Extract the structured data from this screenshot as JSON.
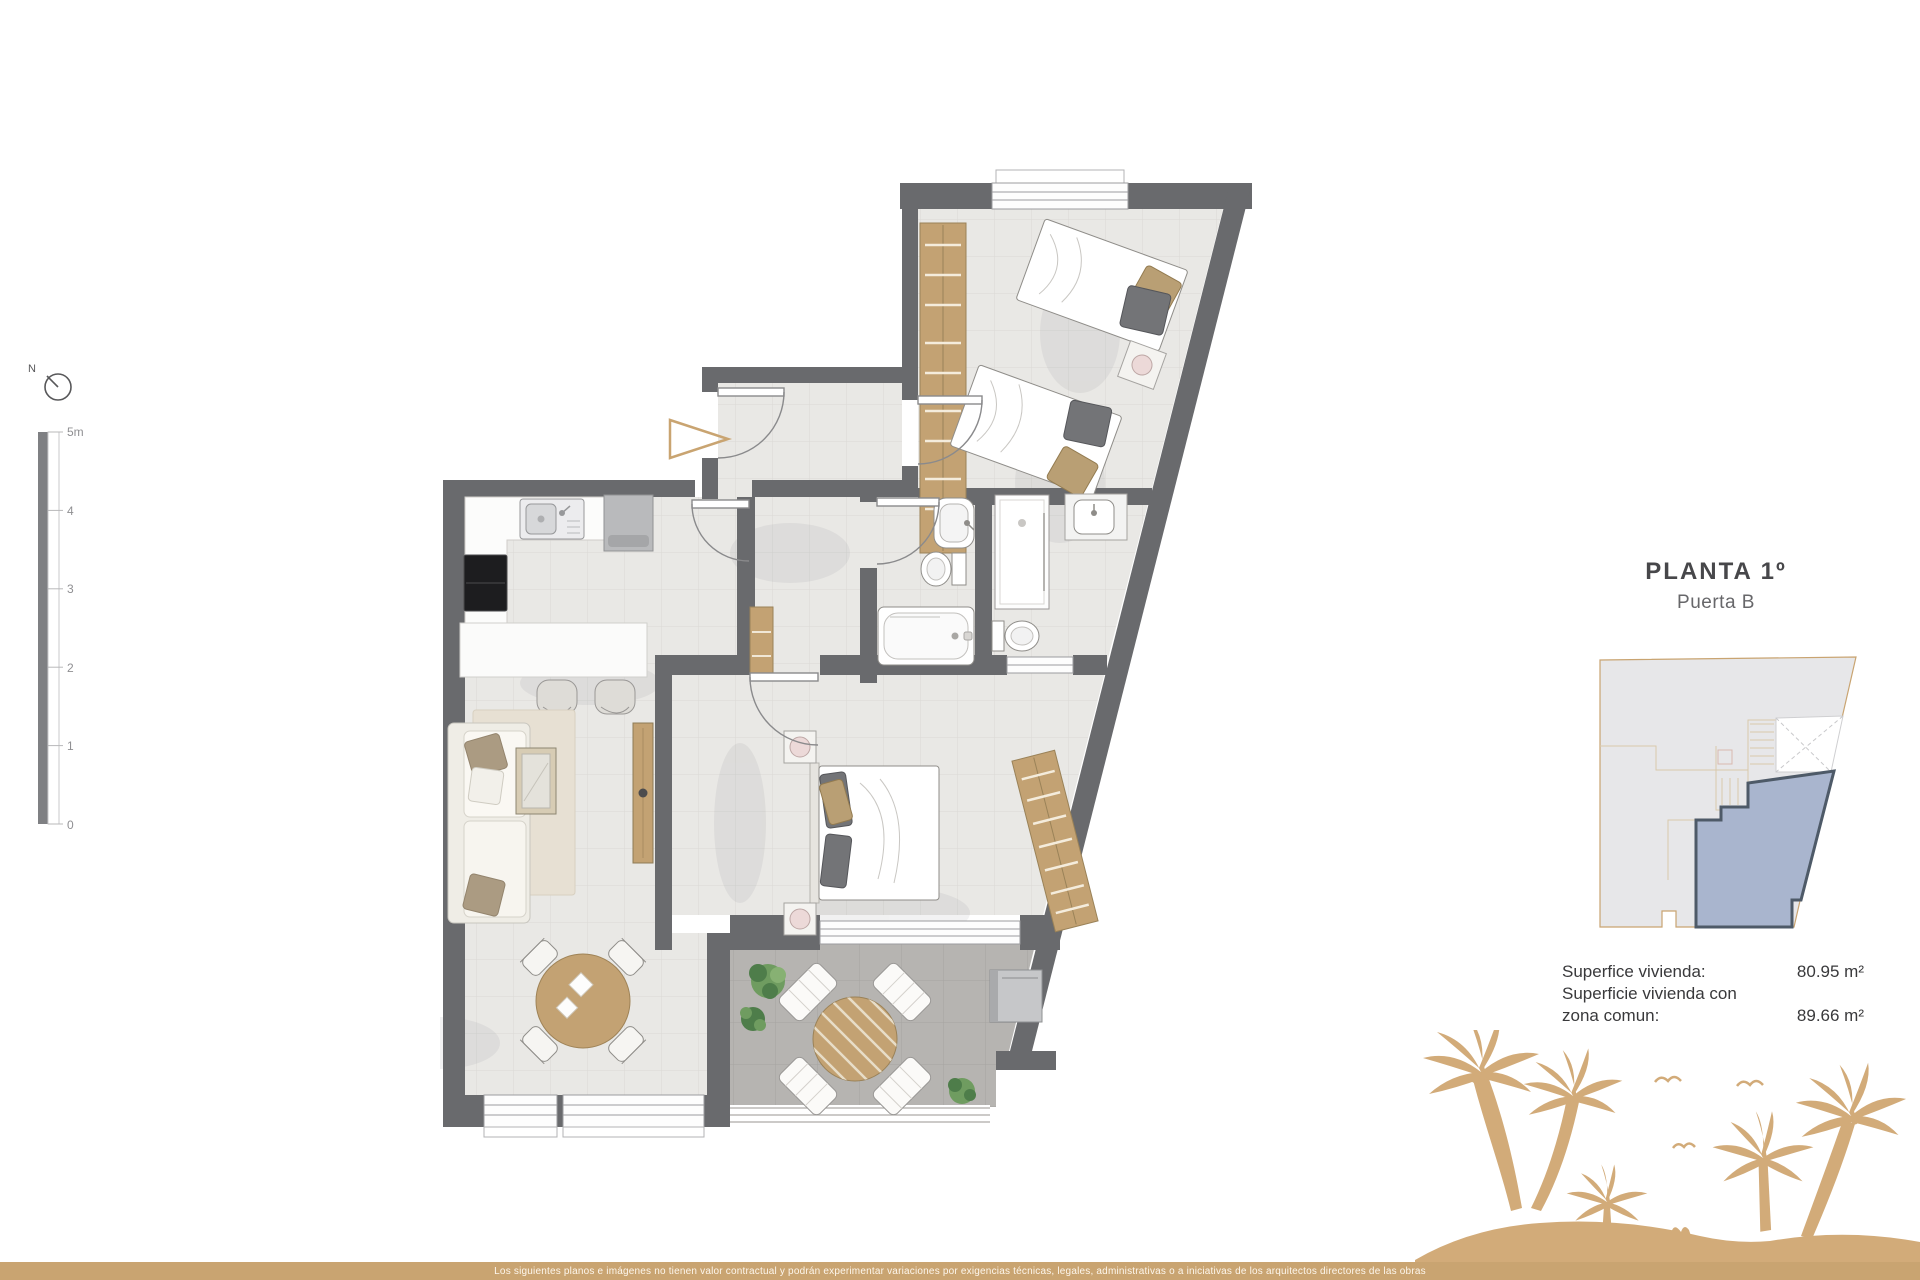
{
  "plan_header": {
    "title": "PLANTA 1º",
    "subtitle": "Puerta B"
  },
  "areas": {
    "rows": [
      {
        "label": "Superfice vivienda:",
        "value": "80.95 m²"
      },
      {
        "label": "Superficie vivienda con",
        "value": ""
      },
      {
        "label": "zona comun:",
        "value": "89.66 m²"
      }
    ]
  },
  "disclaimer": "Los siguientes planos e imágenes no tienen valor contractual y podrán experimentar variaciones por exigencias técnicas, legales, administrativas o a iniciativas de los arquitectos directores de las obras",
  "scale_bar": {
    "labels": [
      "5m",
      "4",
      "3",
      "2",
      "1",
      "0"
    ]
  },
  "compass": {
    "north_label": "N"
  },
  "colors": {
    "accent_tan": "#c9a471",
    "palm_tan": "#d2ab79",
    "wall_gray": "#696a6d",
    "unit_highlight": "#a9b5ce",
    "wood": "#c3a273"
  }
}
